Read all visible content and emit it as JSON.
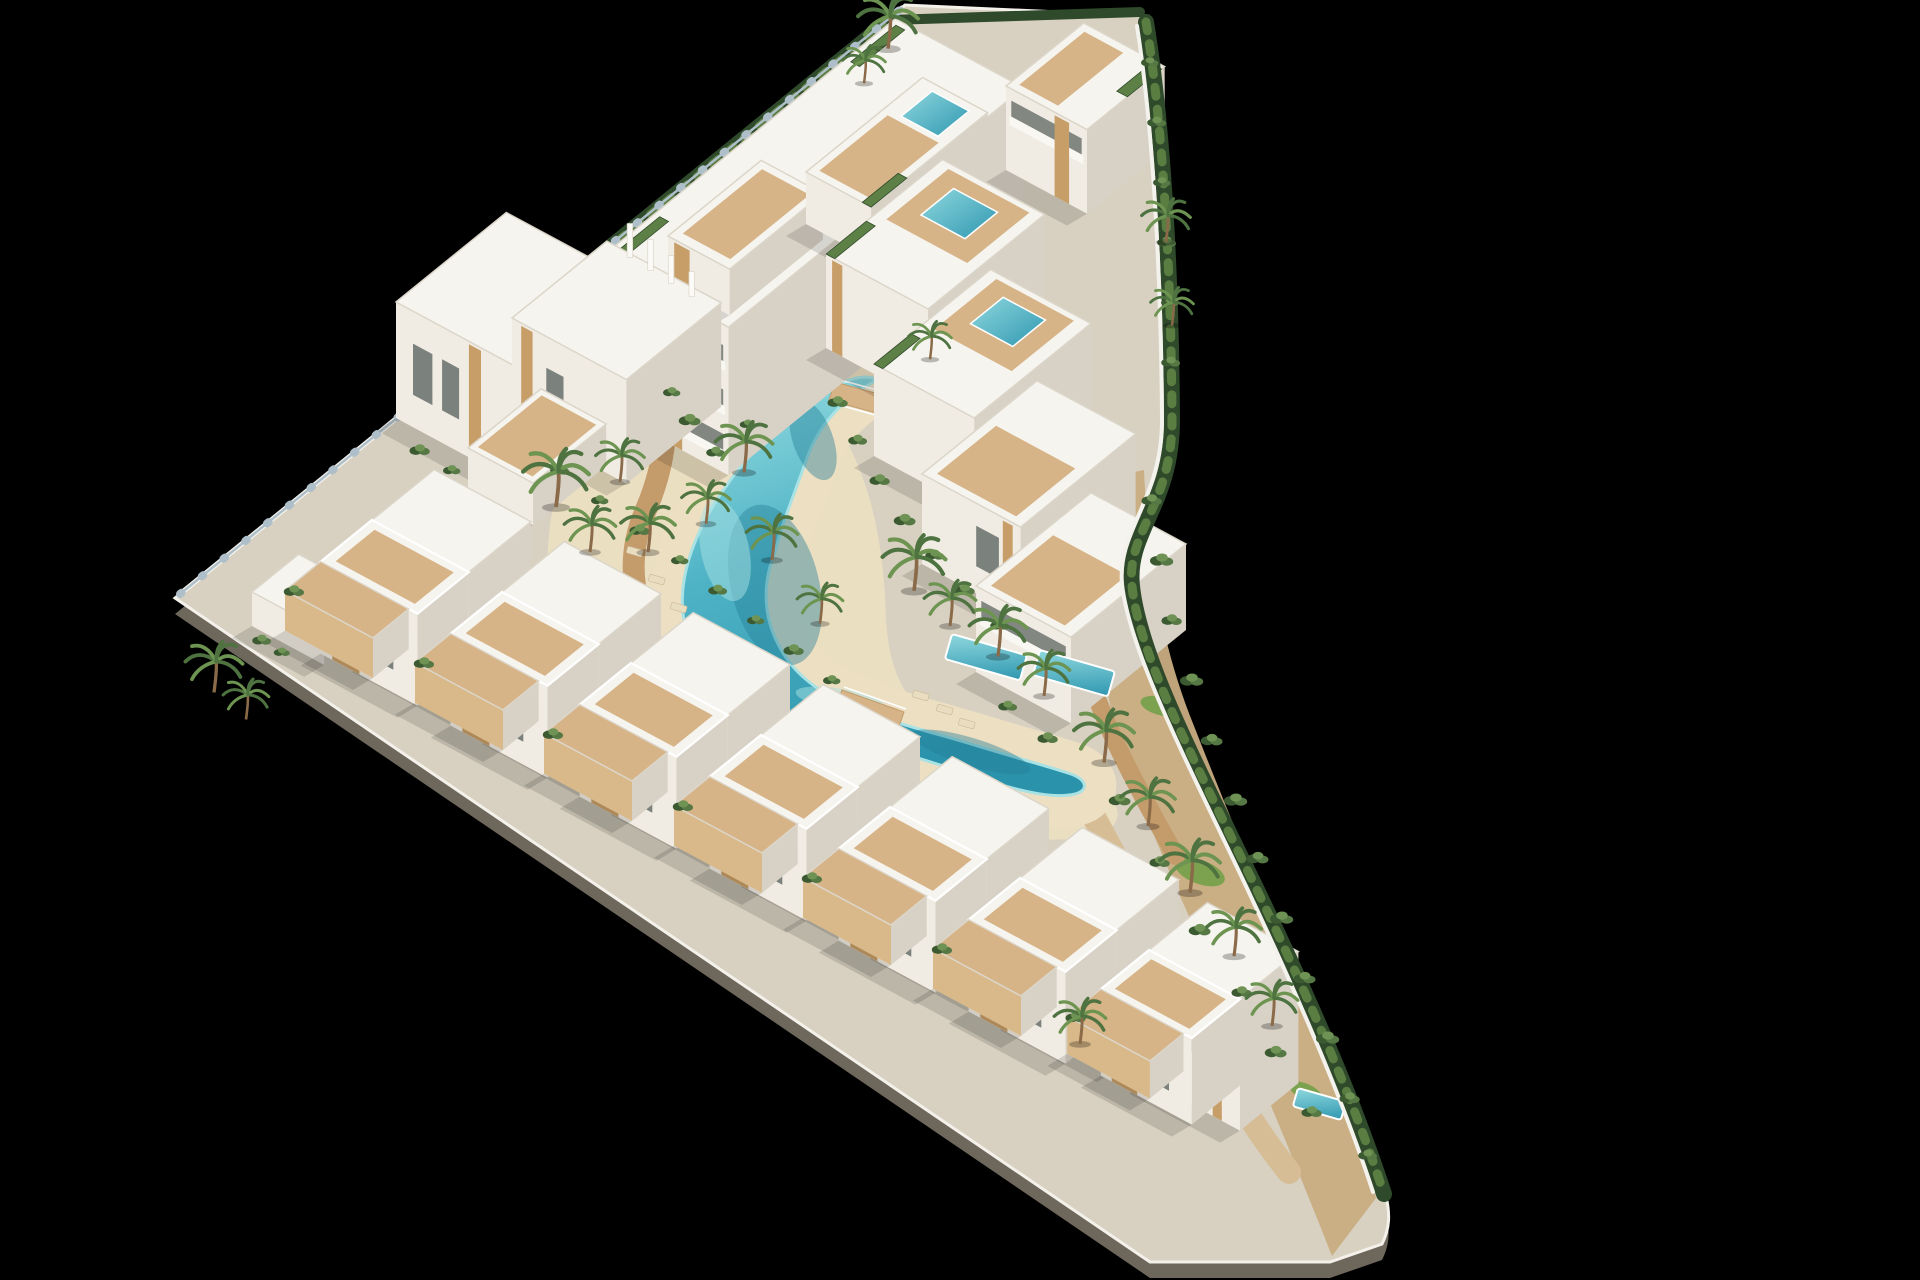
{
  "scene_type": "aerial-3d-architectural-render",
  "colors": {
    "bg": "#000000",
    "plate": "#d8d1c2",
    "plinth": "#6e675b",
    "fascia": "#f3f1ea",
    "beach": "#ecdfc2",
    "dirt": "#c9ad82",
    "dirt_light": "#d6bd95",
    "deck": "#c49b6b",
    "deck_light": "#d7b487",
    "lawn": "#7da24f",
    "water": "#4fb3c6",
    "water_light": "#a8e2e4",
    "water_deep": "#237f96",
    "roof": "#f6f4ee",
    "roof_edge": "#dcd6ca",
    "wall_front": "#f0ece3",
    "wall_side": "#d8d2c6",
    "wall_white": "#f4f2ec",
    "glass_dark": "#6e7570",
    "wood": "#c79e68",
    "wood_fence": "#d9b98a",
    "stone": "#bdae93",
    "hedge_dark": "#2f4a2b",
    "hedge_light": "#5a7d42",
    "roof_hedge": "#5d8046",
    "bush_dark": "#3c5a31",
    "bush_mid": "#557844",
    "bush_light": "#6f9355",
    "palm_dark": "#4e7340",
    "palm_light": "#6d9450",
    "palm_trunk": "#8a6a48",
    "fence_glass": "#aebfc9",
    "lounger": "#e9ddc0",
    "lounger_edge": "#c9b896",
    "shadow": "rgba(0,0,0,0.13)"
  },
  "scene": {
    "canvas": {
      "w": 1920,
      "h": 1280
    },
    "iso": {
      "u": [
        0.777,
        -0.63
      ],
      "v": [
        0.88,
        0.474
      ]
    },
    "site": {
      "outline_d": "M 175 598 L 905 5 L 1148 16 C 1160 110 1170 260 1172 420 C 1173 505 1126 532 1132 588 C 1139 658 1196 766 1256 890 C 1306 994 1354 1098 1386 1196 C 1390 1214 1390 1228 1382 1244 L 1330 1262 L 1150 1262 L 175 598 Z",
      "plinth_dy": 16
    },
    "terrain": {
      "beach_d": "M 574 436 C 540 520 538 606 572 676 C 606 744 690 782 790 802 C 890 822 1010 846 1084 838 C 1128 832 1130 800 1084 780 C 1030 757 970 740 930 716 C 902 698 888 664 886 618 C 884 548 872 478 836 424 C 800 372 706 356 648 378 C 612 392 590 408 574 436 Z",
      "dirt_d": "M 1144 470 C 1148 560 1160 642 1194 726 C 1230 818 1274 922 1320 1032 C 1348 1100 1366 1158 1376 1198 L 1332 1256 C 1302 1180 1262 1082 1218 982 C 1174 882 1132 792 1114 722 C 1096 652 1100 560 1106 478 Z",
      "lawns": [
        [
          1200,
          872,
          26,
          12,
          20
        ],
        [
          1160,
          706,
          20,
          9,
          15
        ],
        [
          1262,
          1002,
          22,
          10,
          25
        ],
        [
          1306,
          1092,
          18,
          8,
          25
        ]
      ]
    },
    "walkways": [
      {
        "d": "M 651 342 C 675 402 667 462 645 512 C 625 560 631 614 667 656 C 705 702 761 724 821 738 C 871 750 915 764 963 780",
        "w": 22,
        "c": "deck"
      },
      {
        "d": "M 880 302 C 906 356 918 414 938 464 C 958 514 990 552 1028 590 C 1060 624 1084 664 1100 706 C 1116 748 1144 800 1176 856",
        "w": 18,
        "c": "deck"
      },
      {
        "d": "M 1075 782 C 1113 852 1151 922 1181 992 C 1211 1057 1249 1122 1289 1172",
        "w": 24,
        "c": "dirt_light"
      }
    ],
    "lagoon": {
      "d": "M 877 380 C 843 398 818 426 807 458 C 793 498 783 520 775 552 C 761 586 765 618 777 642 C 791 672 819 694 857 708 C 889 722 931 732 971 744 C 1013 757 1047 766 1071 774 C 1087 780 1089 790 1075 794 C 1055 799 1023 792 989 781 C 951 768 915 757 879 746 C 839 733 793 720 751 698 C 713 676 687 648 683 614 C 679 578 693 540 713 506 C 735 470 767 432 803 406 C 829 387 861 370 877 380 Z",
      "halo_w": 64,
      "deeps": [
        [
          775,
          585,
          44,
          82,
          -14
        ],
        [
          971,
          752,
          62,
          14,
          17
        ],
        [
          813,
          440,
          20,
          42,
          -20
        ]
      ],
      "shallows": [
        [
          725,
          550,
          24,
          52,
          -12
        ],
        [
          841,
          700,
          46,
          11,
          10
        ]
      ]
    },
    "bridges": [
      {
        "pts": [
          [
            842,
            690
          ],
          [
            904,
            712
          ],
          [
            897,
            732
          ],
          [
            835,
            710
          ]
        ],
        "rails": [
          [
            [
              844,
              687
            ],
            [
              906,
              709
            ]
          ],
          [
            [
              834,
              712
            ],
            [
              896,
              734
            ]
          ]
        ]
      },
      {
        "pts": [
          [
            835,
            382
          ],
          [
            893,
            398
          ],
          [
            887,
            416
          ],
          [
            829,
            400
          ]
        ],
        "rails": [
          [
            [
              837,
              379
            ],
            [
              895,
              395
            ]
          ],
          [
            [
              828,
              402
            ],
            [
              886,
              418
            ]
          ]
        ]
      }
    ],
    "loungers": [
      [
        628,
        546
      ],
      [
        650,
        574
      ],
      [
        672,
        602
      ],
      [
        914,
        690
      ],
      [
        938,
        704
      ],
      [
        960,
        718
      ]
    ],
    "hedges_back": [
      {
        "d": "M 180 594 L 902 8",
        "w": 5,
        "c": "wall_white"
      },
      {
        "d": "M 448 378 L 886 22",
        "w": 14,
        "c": "hedge_dark"
      },
      {
        "d": "M 448 378 L 886 22",
        "w": 7,
        "c": "hedge_light",
        "dash": "8 12"
      },
      {
        "d": "M 890 20 L 1140 12",
        "w": 10,
        "c": "hedge_dark"
      },
      {
        "d": "M 180 594 L 902 8",
        "w": 2.5,
        "c": "fence_glass"
      },
      {
        "d": "M 180 594 L 902 8",
        "w": 8,
        "c": "fence_glass",
        "dash": "2 26"
      }
    ],
    "hedges_front": [
      {
        "d": "M 1146 22 C 1162 120 1171 260 1172 420 C 1172 505 1126 532 1132 586 C 1139 656 1196 764 1256 888 C 1306 992 1352 1096 1384 1194",
        "w": 16,
        "c": "hedge_dark"
      },
      {
        "d": "M 1146 22 C 1162 120 1171 260 1172 420 C 1172 505 1126 532 1132 586 C 1139 656 1196 764 1256 888 C 1306 992 1352 1096 1384 1194",
        "w": 9,
        "c": "hedge_light",
        "dash": "9 13"
      },
      {
        "d": "M 1137 26 C 1152 122 1161 262 1162 420 C 1162 500 1117 530 1122 584 C 1129 650 1186 760 1245 884 C 1295 990 1341 1094 1373 1192",
        "w": 4,
        "c": "wall_white"
      }
    ],
    "blocks": [
      {
        "name": "apartment-slab",
        "x": 600,
        "y": 258,
        "w": 380,
        "d": 146,
        "h": 148,
        "bands": 3,
        "wood": [
          [
            0.03,
            0.12
          ],
          [
            0.56,
            0.64
          ]
        ],
        "stone": [
          [
            0.47,
            0.52
          ]
        ],
        "roofHedge": [
          [
            8,
            6,
            70,
            16
          ],
          [
            316,
            6,
            374,
            16
          ]
        ]
      },
      {
        "name": "roof-terrace-west",
        "x": 668,
        "y": 236,
        "w": 120,
        "d": 70,
        "h": 46,
        "wood": [
          [
            0.1,
            0.35
          ]
        ],
        "roofDeck": [
          [
            10,
            8,
            112,
            62
          ]
        ]
      },
      {
        "name": "roof-terrace-east",
        "x": 806,
        "y": 172,
        "w": 150,
        "d": 74,
        "h": 52,
        "roofDeck": [
          [
            8,
            8,
            96,
            66
          ]
        ],
        "roofPool": [
          [
            102,
            18,
            142,
            60
          ]
        ],
        "roofHedge": [
          [
            0,
            64,
            46,
            74
          ]
        ]
      },
      {
        "name": "penthouse",
        "x": 1006,
        "y": 86,
        "w": 100,
        "d": 92,
        "h": 84,
        "bands": 1,
        "wood": [
          [
            0.6,
            0.78
          ]
        ],
        "roofDeck": [
          [
            8,
            8,
            92,
            52
          ]
        ],
        "roofHedge": [
          [
            52,
            80,
            96,
            92
          ]
        ]
      },
      {
        "name": "duplex-west",
        "x": 396,
        "y": 302,
        "w": 142,
        "d": 138,
        "h": 116,
        "wood": [
          [
            0.6,
            0.7
          ]
        ],
        "win": [
          [
            0.14,
            0.3,
            0.28,
            0.72
          ],
          [
            0.38,
            0.52,
            0.28,
            0.72
          ]
        ]
      },
      {
        "name": "duplex-east",
        "x": 512,
        "y": 318,
        "w": 122,
        "d": 130,
        "h": 104,
        "fins": 4,
        "wood": [
          [
            0.08,
            0.18
          ]
        ],
        "win": [
          [
            0.3,
            0.45,
            0.3,
            0.7
          ]
        ]
      },
      {
        "name": "duplex-terrace",
        "x": 468,
        "y": 448,
        "w": 94,
        "d": 74,
        "h": 42,
        "roofDeck": [
          [
            6,
            6,
            88,
            68
          ]
        ]
      },
      {
        "name": "terrace-house-1",
        "x": 826,
        "y": 254,
        "w": 150,
        "d": 116,
        "h": 94,
        "roofDeck": [
          [
            64,
            12,
            144,
            104
          ]
        ],
        "roofPool": [
          [
            86,
            32,
            128,
            82
          ]
        ],
        "roofHedge": [
          [
            0,
            0,
            52,
            10
          ]
        ],
        "wood": [
          [
            0.06,
            0.16
          ]
        ]
      },
      {
        "name": "terrace-house-2",
        "x": 874,
        "y": 364,
        "w": 150,
        "d": 114,
        "h": 92,
        "roofDeck": [
          [
            64,
            12,
            144,
            100
          ]
        ],
        "roofPool": [
          [
            88,
            32,
            130,
            80
          ]
        ],
        "roofHedge": [
          [
            0,
            0,
            48,
            10
          ]
        ]
      },
      {
        "name": "terrace-house-3",
        "x": 922,
        "y": 474,
        "w": 148,
        "d": 112,
        "h": 90,
        "roofDeck": [
          [
            8,
            10,
            84,
            100
          ]
        ],
        "win": [
          [
            0.55,
            0.78,
            0.25,
            0.7
          ]
        ],
        "wood": [
          [
            0.82,
            0.92
          ]
        ]
      },
      {
        "name": "terrace-house-4",
        "x": 976,
        "y": 586,
        "w": 148,
        "d": 108,
        "h": 86,
        "bands": 1,
        "roofDeck": [
          [
            8,
            10,
            88,
            94
          ]
        ]
      },
      {
        "name": "apex-terrace",
        "x": 252,
        "y": 592,
        "w": 60,
        "d": 82,
        "h": 34
      }
    ],
    "ground_pools": [
      {
        "x": 952,
        "y": 634,
        "w": 78,
        "h": 26,
        "rot": 16
      },
      {
        "x": 1040,
        "y": 650,
        "w": 78,
        "h": 26,
        "rot": 16
      },
      {
        "x": 1298,
        "y": 1088,
        "w": 50,
        "h": 19,
        "rot": 16
      }
    ],
    "villas": [
      [
        372,
        520
      ],
      [
        502,
        592
      ],
      [
        631,
        663
      ],
      [
        761,
        735
      ],
      [
        890,
        807
      ],
      [
        1020,
        878
      ],
      [
        1149,
        950,
        0.94
      ]
    ],
    "villa_dims": {
      "rear_w": 80,
      "rear_d": 110,
      "rear_h": 140,
      "front_w": 66,
      "front_h": 92,
      "terrace_w": 46,
      "terrace_d": 100,
      "terrace_h": 40
    },
    "bushes": [
      [
        420,
        450,
        1.4
      ],
      [
        452,
        470,
        1.2
      ],
      [
        560,
        470,
        1.3
      ],
      [
        600,
        500,
        1.2
      ],
      [
        640,
        530,
        1.4
      ],
      [
        680,
        560,
        1.2
      ],
      [
        718,
        590,
        1.3
      ],
      [
        756,
        620,
        1.2
      ],
      [
        794,
        650,
        1.4
      ],
      [
        832,
        680,
        1.2
      ],
      [
        690,
        420,
        1.5
      ],
      [
        716,
        452,
        1.3
      ],
      [
        748,
        424,
        1.1
      ],
      [
        672,
        392,
        1.2
      ],
      [
        905,
        520,
        1.5
      ],
      [
        935,
        555,
        1.3
      ],
      [
        965,
        590,
        1.4
      ],
      [
        1000,
        625,
        1.3
      ],
      [
        880,
        480,
        1.4
      ],
      [
        858,
        440,
        1.3
      ],
      [
        838,
        402,
        1.4
      ],
      [
        1008,
        706,
        1.3
      ],
      [
        1048,
        738,
        1.4
      ],
      [
        1152,
        500,
        1.4
      ],
      [
        1162,
        560,
        1.6
      ],
      [
        1172,
        620,
        1.4
      ],
      [
        1192,
        680,
        1.6
      ],
      [
        1212,
        740,
        1.5
      ],
      [
        1236,
        800,
        1.6
      ],
      [
        1258,
        858,
        1.5
      ],
      [
        1282,
        918,
        1.6
      ],
      [
        1305,
        978,
        1.5
      ],
      [
        1328,
        1038,
        1.6
      ],
      [
        1350,
        1098,
        1.4
      ],
      [
        1368,
        1155,
        1.3
      ],
      [
        1150,
        62,
        1.2
      ],
      [
        1157,
        122,
        1.3
      ],
      [
        1162,
        182,
        1.2
      ],
      [
        1167,
        242,
        1.3
      ],
      [
        1170,
        302,
        1.2
      ],
      [
        1171,
        362,
        1.3
      ],
      [
        262,
        640,
        1.3
      ],
      [
        282,
        652,
        1.1
      ],
      [
        1120,
        800,
        1.5
      ],
      [
        1160,
        862,
        1.4
      ],
      [
        1200,
        930,
        1.5
      ],
      [
        1242,
        992,
        1.4
      ],
      [
        1276,
        1052,
        1.5
      ],
      [
        1312,
        1112,
        1.4
      ]
    ],
    "palms": [
      [
        556,
        502,
        1.15
      ],
      [
        590,
        548,
        0.9
      ],
      [
        620,
        478,
        0.85
      ],
      [
        214,
        688,
        1.0
      ],
      [
        246,
        716,
        0.8
      ],
      [
        744,
        468,
        1.0
      ],
      [
        706,
        520,
        0.85
      ],
      [
        772,
        556,
        0.9
      ],
      [
        648,
        548,
        0.95
      ],
      [
        914,
        586,
        1.1
      ],
      [
        950,
        622,
        0.9
      ],
      [
        998,
        652,
        1.0
      ],
      [
        1044,
        692,
        0.9
      ],
      [
        1104,
        758,
        1.05
      ],
      [
        1148,
        822,
        0.95
      ],
      [
        1190,
        888,
        1.05
      ],
      [
        1234,
        952,
        0.95
      ],
      [
        1272,
        1022,
        0.9
      ],
      [
        888,
        44,
        1.05
      ],
      [
        864,
        80,
        0.75
      ],
      [
        1166,
        238,
        0.85
      ],
      [
        1172,
        322,
        0.75
      ],
      [
        1080,
        1040,
        0.9
      ],
      [
        930,
        356,
        0.75
      ],
      [
        820,
        620,
        0.8
      ]
    ]
  }
}
